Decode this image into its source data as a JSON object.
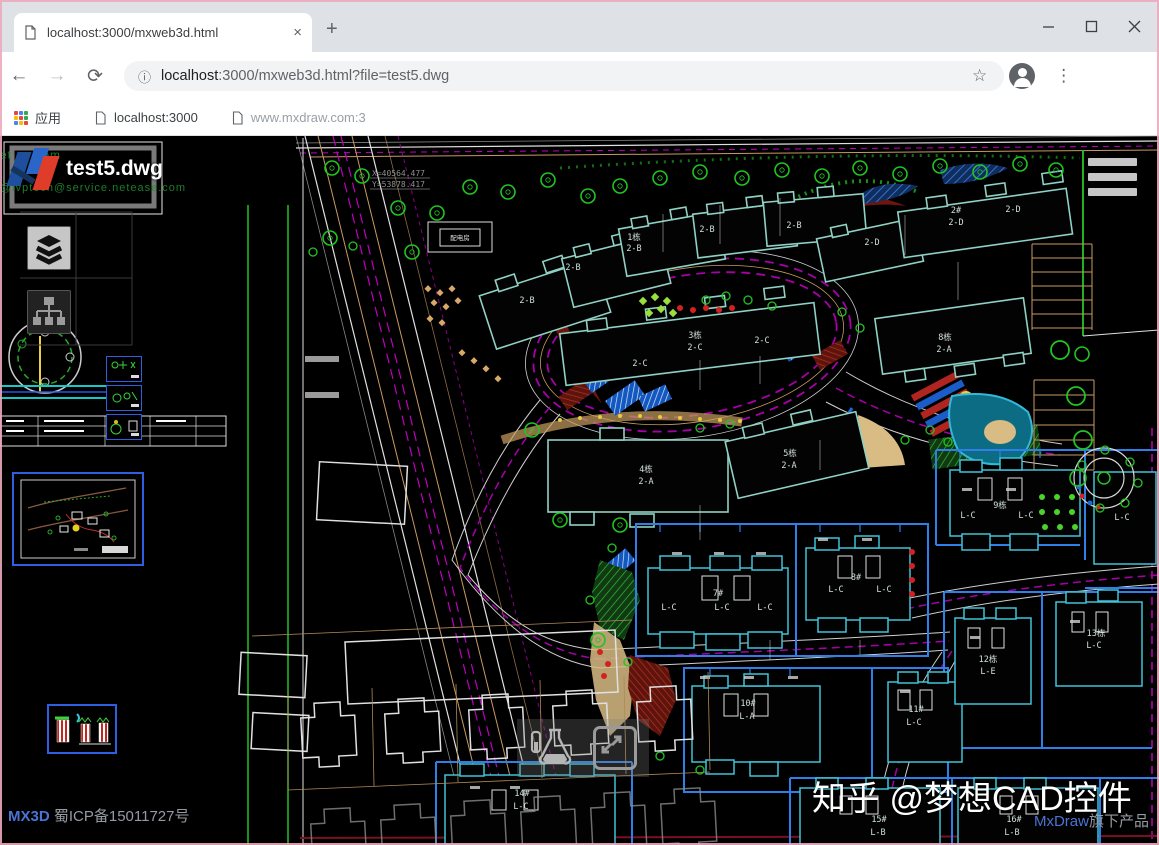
{
  "browser": {
    "tab": {
      "title": "localhost:3000/mxweb3d.html"
    },
    "icons": {
      "tab_close": "×",
      "new_tab": "+",
      "back": "←",
      "forward": "→",
      "reload": "⟳",
      "info": "ⓘ",
      "star": "☆",
      "menu_dots": "⋮"
    },
    "address": {
      "host": "localhost",
      "rest": ":3000/mxweb3d.html?file=test5.dwg"
    },
    "bookmarks": {
      "apps_label": "应用",
      "items": [
        {
          "label": "localhost:3000"
        },
        {
          "label": "www.mxdraw.com:3"
        }
      ]
    }
  },
  "viewer": {
    "doc_title": "test5.dwg",
    "green_watermark_top": "et    se.com",
    "green_watermark": "@ivptech@service.netease.com",
    "zhihu_watermark": "知乎 @梦想CAD控件",
    "coord_x": "X=40564.477",
    "coord_y": "Y=53878.417",
    "footer_left": {
      "brand": "MX3D",
      "icp": "蜀ICP备15011727号"
    },
    "footer_right": {
      "brand": "MxDraw",
      "text": "旗下产品"
    }
  },
  "plan": {
    "colors": {
      "background": "#000000",
      "building_outline_top": "#8fd1c4",
      "building_outline_bottom": "#3fc3d8",
      "lot_line_blue": "#2e7fe8",
      "road_magenta": "#a800a8",
      "tree_green": "#23c323",
      "tan": "#c89a62",
      "white_line": "#e0e0e0",
      "red": "#d42020",
      "link_blue": "#4a74d4"
    },
    "labels": [
      {
        "t": "2-B"
      },
      {
        "t": "2-B"
      },
      {
        "t": "1栋"
      },
      {
        "t": "2-B"
      },
      {
        "t": "2-B"
      },
      {
        "t": "2-B"
      },
      {
        "t": "2-D"
      },
      {
        "t": "2#"
      },
      {
        "t": "2-D"
      },
      {
        "t": "2-D"
      },
      {
        "t": "3栋"
      },
      {
        "t": "2-C"
      },
      {
        "t": "2-C"
      },
      {
        "t": "2-C"
      },
      {
        "t": "4栋"
      },
      {
        "t": "2-A"
      },
      {
        "t": "5栋"
      },
      {
        "t": "2-A"
      },
      {
        "t": "8栋"
      },
      {
        "t": "2-A"
      },
      {
        "t": "配电房"
      },
      {
        "t": "7#"
      },
      {
        "t": "L-C"
      },
      {
        "t": "L-C"
      },
      {
        "t": "L-C"
      },
      {
        "t": "8#"
      },
      {
        "t": "L-C"
      },
      {
        "t": "L-C"
      },
      {
        "t": "9栋"
      },
      {
        "t": "L-C"
      },
      {
        "t": "L-C"
      },
      {
        "t": "L-C"
      },
      {
        "t": "10#"
      },
      {
        "t": "L-A"
      },
      {
        "t": "11#"
      },
      {
        "t": "L-C"
      },
      {
        "t": "12栋"
      },
      {
        "t": "L-E"
      },
      {
        "t": "13栋"
      },
      {
        "t": "L-C"
      },
      {
        "t": "14#"
      },
      {
        "t": "L-C"
      },
      {
        "t": "15#"
      },
      {
        "t": "L-B"
      },
      {
        "t": "16#"
      },
      {
        "t": "L-B"
      }
    ]
  }
}
